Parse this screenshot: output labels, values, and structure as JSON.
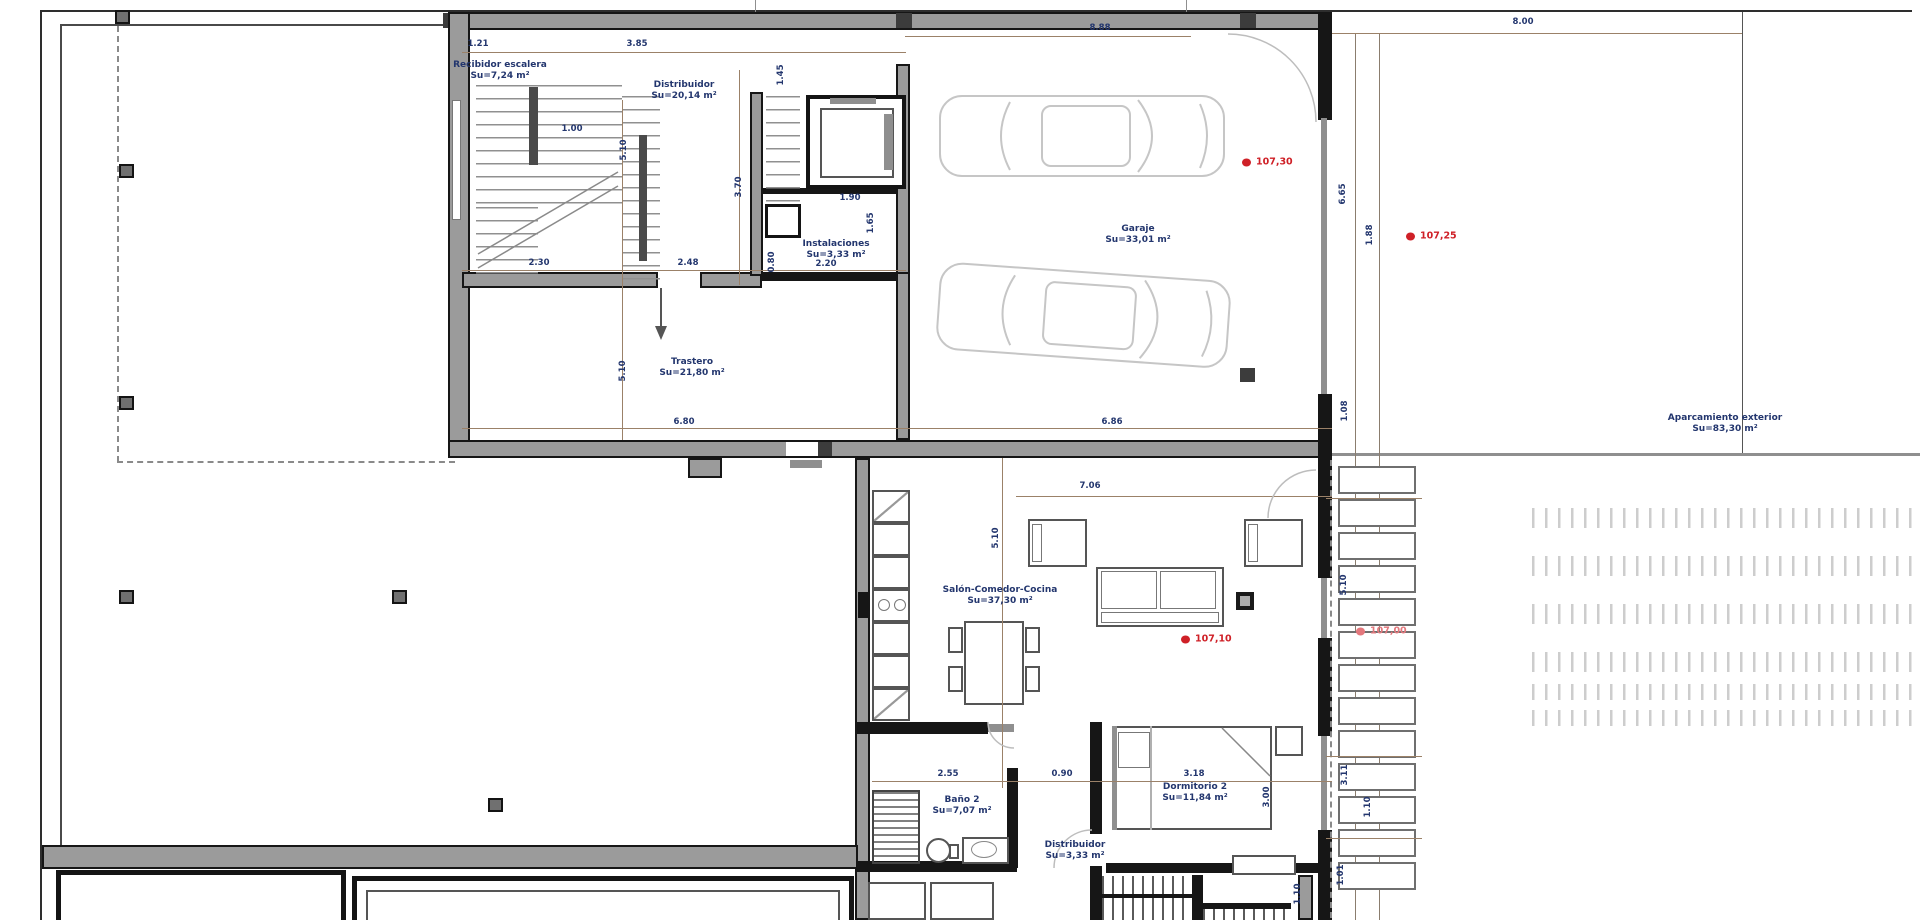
{
  "drawing_title": "Planta - plano de vivienda",
  "rooms": [
    {
      "name": "Recibidor escalera",
      "area": "Su=7,24 m²"
    },
    {
      "name": "Distribuidor",
      "area": "Su=20,14 m²"
    },
    {
      "name": "Instalaciones",
      "area": "Su=3,33 m²"
    },
    {
      "name": "Garaje",
      "area": "Su=33,01 m²"
    },
    {
      "name": "Trastero",
      "area": "Su=21,80 m²"
    },
    {
      "name": "Aparcamiento exterior",
      "area": "Su=83,30 m²"
    },
    {
      "name": "Salón-Comedor-Cocina",
      "area": "Su=37,30 m²"
    },
    {
      "name": "Baño 2",
      "area": "Su=7,07 m²"
    },
    {
      "name": "Distribuidor",
      "area": "Su=3,33 m²"
    },
    {
      "name": "Dormitorio 2",
      "area": "Su=11,84 m²"
    }
  ],
  "levels": [
    {
      "label": "107,30"
    },
    {
      "label": "107,25"
    },
    {
      "label": "107,10"
    },
    {
      "label": "107,00"
    }
  ],
  "dims": [
    "1.21",
    "3.85",
    "8.88",
    "8.00",
    "1.00",
    "5.10",
    "3.70",
    "2.30",
    "2.48",
    "1.90",
    "1.65",
    "0.80",
    "2.20",
    "1.45",
    "6.80",
    "6.86",
    "5.10",
    "6.65",
    "1.88",
    "7.06",
    "5.10",
    "2.55",
    "0.90",
    "3.18",
    "3.00",
    "1.10",
    "1.08",
    "5.10",
    "3.11",
    "1.10",
    "1.01"
  ],
  "colors": {
    "wall": "#161616",
    "wall_fill": "#9b9b9b",
    "dimension_line": "#9b8168",
    "dimension_text": "#23366e",
    "label_text": "#23366e",
    "level_marker_red": "#cf2027",
    "level_marker_pink": "#e4787d",
    "car_outline": "#c6c6c6",
    "background": "#ffffff"
  }
}
